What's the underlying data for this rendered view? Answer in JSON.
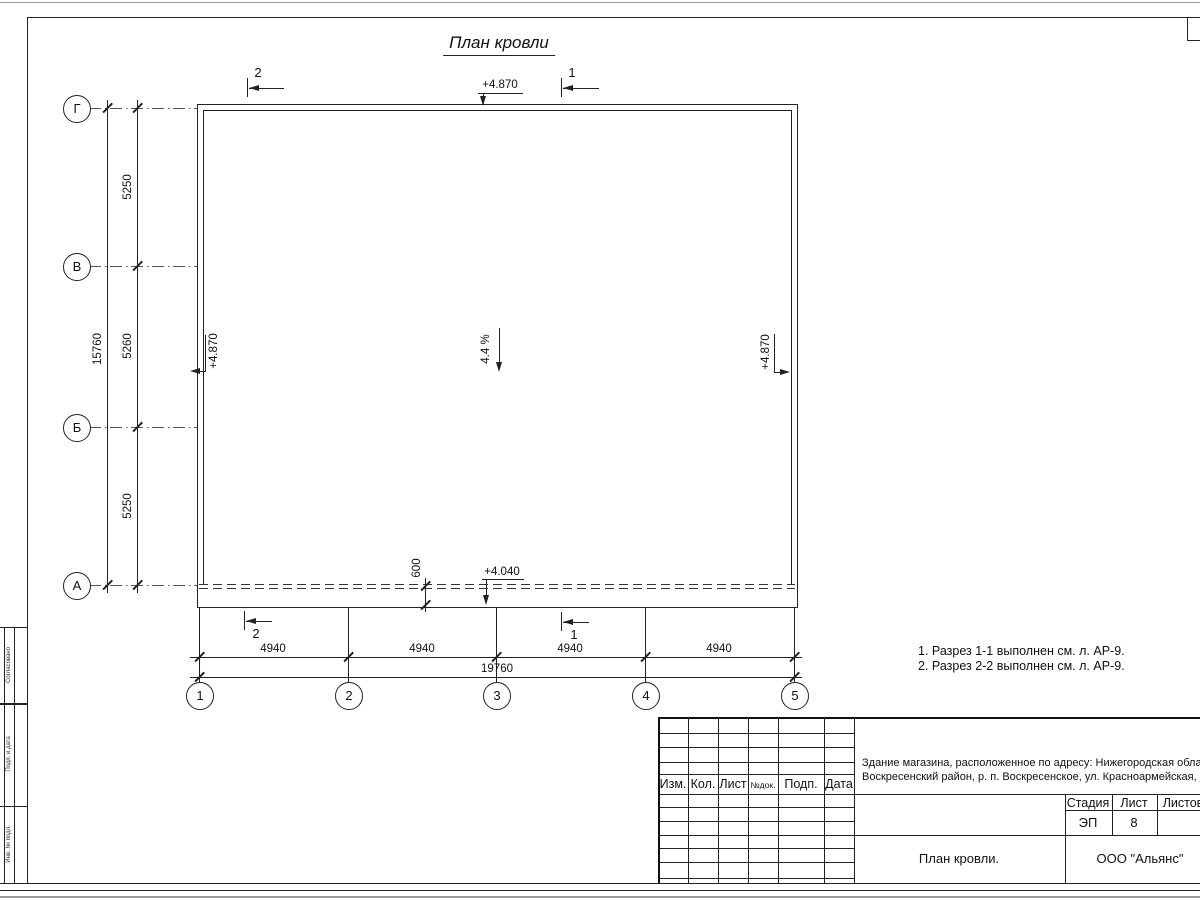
{
  "title": "План кровли",
  "axes": {
    "rows": [
      "Г",
      "В",
      "Б",
      "А"
    ],
    "cols": [
      "1",
      "2",
      "3",
      "4",
      "5"
    ]
  },
  "dims": {
    "v": [
      "5250",
      "5260",
      "5250"
    ],
    "v_total": "15760",
    "h": [
      "4940",
      "4940",
      "4940",
      "4940"
    ],
    "h_total": "19760",
    "overhang": "600"
  },
  "elev": {
    "top": "+4.870",
    "left": "+4.870",
    "right": "+4.870",
    "eaves": "+4.040"
  },
  "slope": "4.4 %",
  "sections": {
    "top_left": "2",
    "top_right": "1",
    "bottom_left": "2",
    "bottom_right": "1"
  },
  "notes": [
    "1. Разрез 1-1 выполнен см. л. АР-9.",
    "2. Разрез 2-2 выполнен см. л. АР-9."
  ],
  "tb": {
    "cols": [
      "Изм.",
      "Кол.",
      "Лист",
      "№док.",
      "Подп.",
      "Дата"
    ],
    "object": [
      "Здание магазина, расположенное по адресу: Нижегородская область,",
      "Воскресенский район, р. п. Воскресенское, ул. Красноармейская, д. 1"
    ],
    "stage_h": "Стадия",
    "sheet_h": "Лист",
    "sheets_h": "Листов",
    "stage": "ЭП",
    "sheet": "8",
    "title": "План кровли.",
    "org": "ООО \"Альянс\""
  },
  "margin": [
    "Согласовано",
    "Подп. и дата",
    "Инв. № подл."
  ]
}
